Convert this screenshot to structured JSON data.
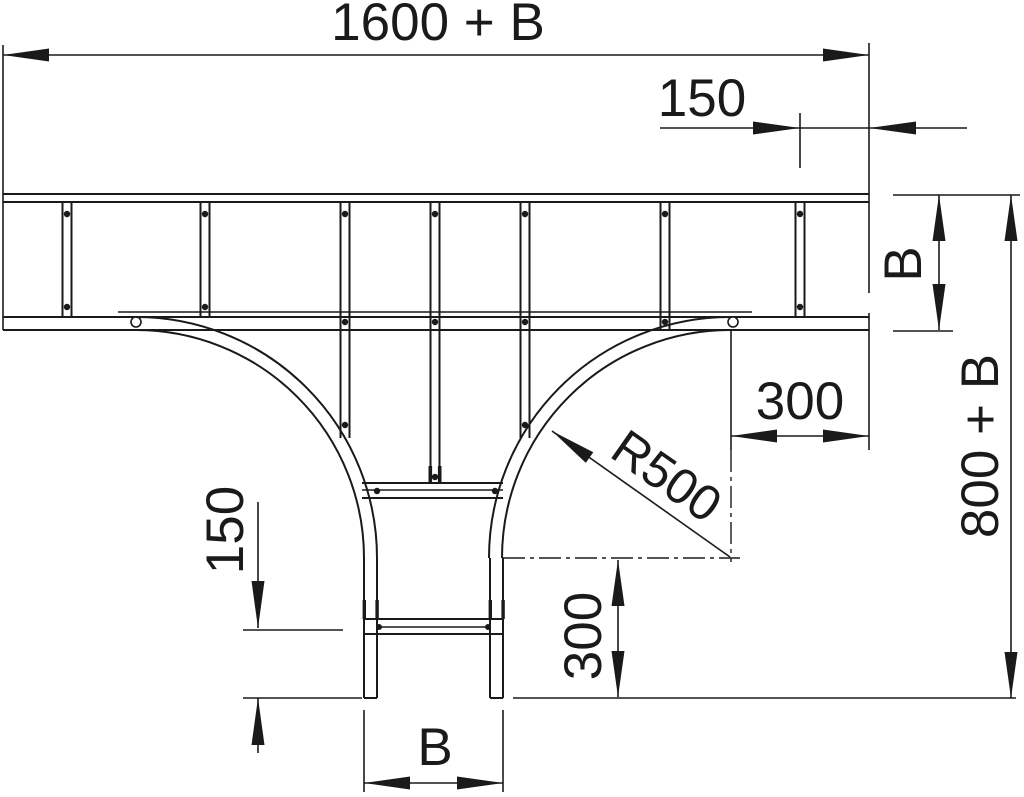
{
  "colors": {
    "ink": "#1a1a1a",
    "background": "#ffffff"
  },
  "dims": {
    "overall_length": "1600 + B",
    "end_rung_offset": "150",
    "main_width": "B",
    "overall_depth": "800 + B",
    "corner_to_end": "300",
    "bend_radius": "R500",
    "branch_rung_to_end": "150",
    "center_to_branch_end": "300",
    "branch_width": "B"
  }
}
